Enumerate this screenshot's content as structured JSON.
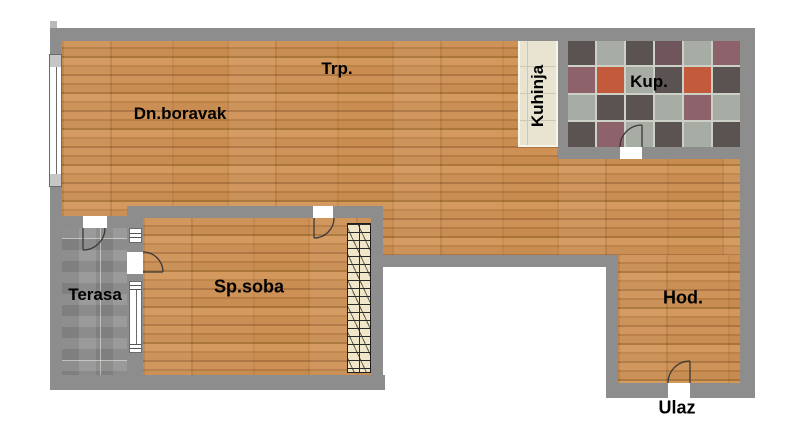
{
  "rooms": {
    "dining": {
      "label": "Trp."
    },
    "living": {
      "label": "Dn.boravak"
    },
    "kitchen": {
      "label": "Kuhinja"
    },
    "bathroom": {
      "label": "Kup."
    },
    "terrace": {
      "label": "Terasa"
    },
    "bedroom": {
      "label": "Sp.soba"
    },
    "hallway": {
      "label": "Hod."
    },
    "entrance": {
      "label": "Ulaz"
    }
  },
  "colors": {
    "wall": "#8d8d8d",
    "wood_base": "#c68a50",
    "terrace": "#8e8e8e",
    "kitchen_counter": "#e9e3d1",
    "wardrobe": "#efe7c8",
    "outline": "#3a3a3a"
  },
  "bathroom_tiles": {
    "grout": "#cdd0c6",
    "palette": {
      "D": "#5a5351",
      "L": "#a7aca4",
      "M": "#8d626b",
      "R": "#c45a3c",
      "P": "#6f565c"
    },
    "rows": [
      "DLDPLM",
      "MRLDRD",
      "LDDLML",
      "DMLDLD"
    ]
  }
}
